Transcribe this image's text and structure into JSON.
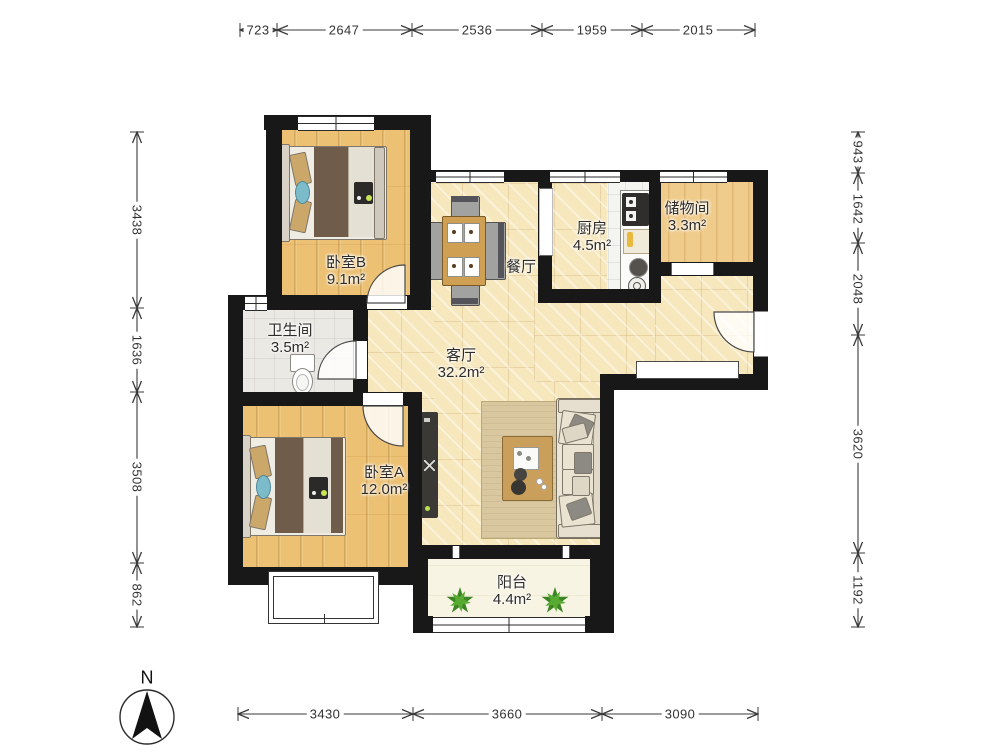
{
  "plan": {
    "compass": {
      "north_label": "N"
    },
    "rooms": {
      "bedroom_b": {
        "name": "卧室B",
        "area": "9.1m²"
      },
      "kitchen": {
        "name": "厨房",
        "area": "4.5m²"
      },
      "storage": {
        "name": "储物间",
        "area": "3.3m²"
      },
      "dining": {
        "name": "餐厅"
      },
      "bathroom": {
        "name": "卫生间",
        "area": "3.5m²"
      },
      "living": {
        "name": "客厅",
        "area": "32.2m²"
      },
      "bedroom_a": {
        "name": "卧室A",
        "area": "12.0m²"
      },
      "balcony": {
        "name": "阳台",
        "area": "4.4m²"
      }
    },
    "dimensions": {
      "top": [
        "723",
        "2647",
        "2536",
        "1959",
        "2015"
      ],
      "left": [
        "3438",
        "1636",
        "3508",
        "862"
      ],
      "right": [
        "943",
        "1642",
        "2048",
        "3620",
        "1192"
      ],
      "bottom": [
        "3430",
        "3660",
        "3090"
      ]
    },
    "colors": {
      "wall": "#181818",
      "wood_floor": "#ecc173",
      "living_tile": "#f7e7bc",
      "kitchen_tile": "#f4f4f0",
      "bath_tile": "#ebe9e4",
      "balcony_floor": "#f8f4e3",
      "rug": "#d9c89f",
      "blanket_brown": "#6f5c4a",
      "cushion_blue": "#7cbbca",
      "plant_green": "#4f9e2e"
    }
  }
}
